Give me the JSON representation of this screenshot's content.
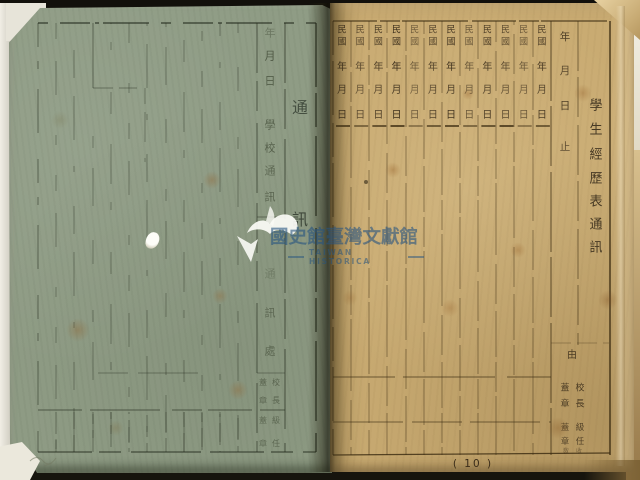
{
  "watermark": {
    "logo": "dove-book-logo",
    "cn_text": "國史館臺灣文獻館",
    "en_text": "TAIWAN HISTORICA",
    "color": "#26547f"
  },
  "left_page": {
    "paper_color": "#8f9c85",
    "title_vertical": "通訊",
    "date_chars": "年月日",
    "section_label": "學校通訊",
    "address_label": "通訊處",
    "seal_cells": [
      {
        "name": "校長",
        "annotation": "蓋章"
      },
      {
        "name": "級任",
        "annotation": "蓋章"
      }
    ]
  },
  "right_page": {
    "paper_color": "#c9ab72",
    "title_vertical": "學生經歷表通訊",
    "column_count": 12,
    "column_header": {
      "era": "民國",
      "year": "年",
      "month": "月",
      "day": "日"
    },
    "date_column_header": "年月日止",
    "seal_cell": {
      "lead": "由",
      "entries": [
        {
          "name": "校長",
          "annotation": "蓋章"
        },
        {
          "name": "級任",
          "annotation": "蓋章"
        }
      ],
      "faint_chars": "敎收"
    },
    "page_number": "( 10 )"
  }
}
